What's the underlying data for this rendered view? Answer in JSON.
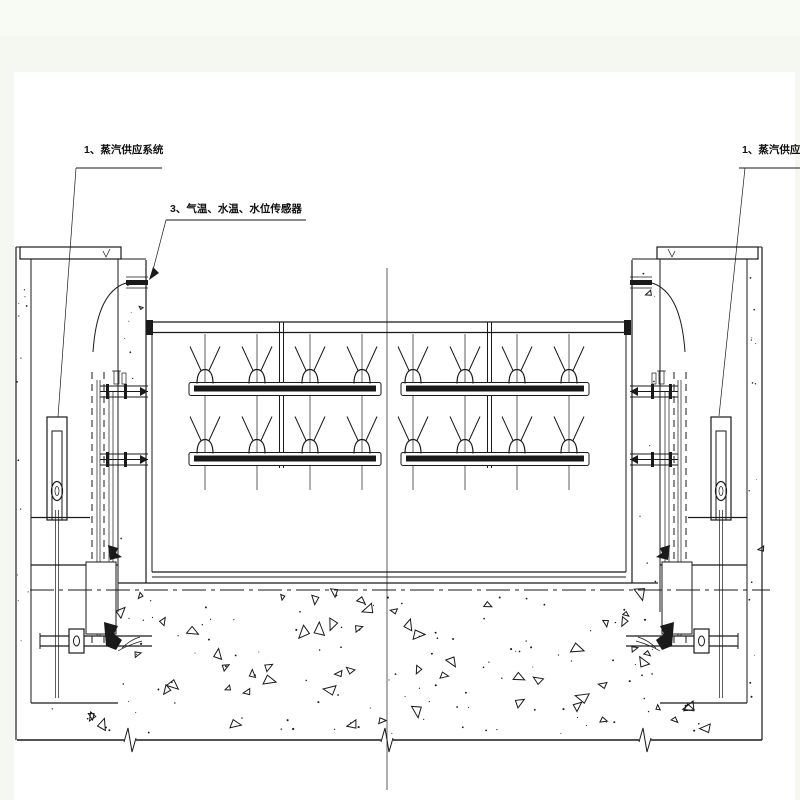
{
  "labels": {
    "left_system": {
      "text": "1、蒸汽供应系统"
    },
    "sensors": {
      "text": "3、气温、水温、水位传感器"
    },
    "right_system": {
      "text": "1、蒸汽供应系统"
    }
  },
  "colors": {
    "line": "#1a1a1a",
    "page": "#ffffff",
    "canvas": "#f5f8f0",
    "text": "#111111"
  }
}
